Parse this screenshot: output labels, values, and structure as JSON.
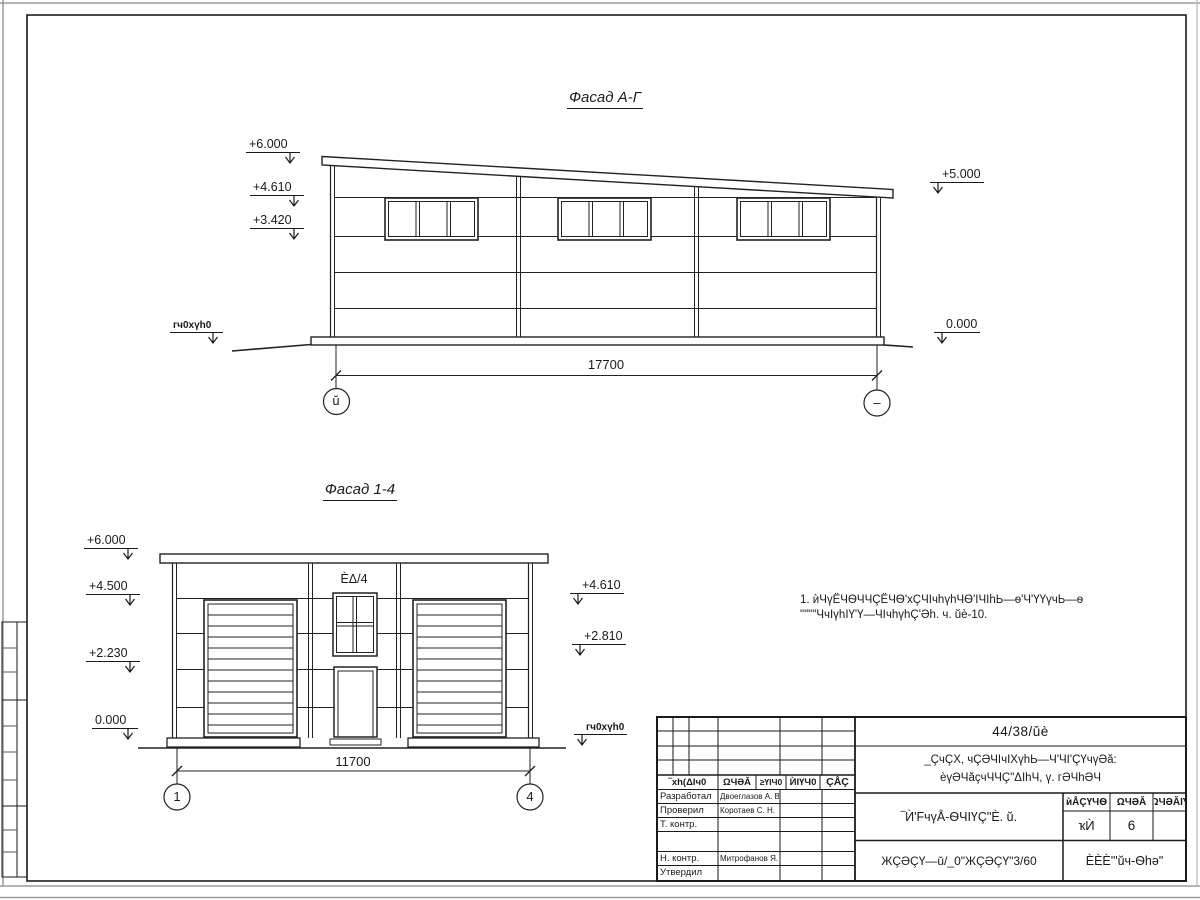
{
  "drawing": {
    "facade_top": {
      "title": "Фасад А-Г",
      "dimension": "17700",
      "axis_left": "ŭ",
      "axis_right": "–",
      "elevations": [
        "+6.000",
        "+4.610",
        "+3.420",
        "+5.000",
        "0.000"
      ],
      "ground_label": "ᴦч0хүh0"
    },
    "facade_bottom": {
      "title": "Фасад 1-4",
      "dimension": "11700",
      "axis_left": "1",
      "axis_right": "4",
      "window_label": "ÈΔ/4",
      "elevations": [
        "+6.000",
        "+4.500",
        "+2.230",
        "0.000",
        "+4.610",
        "+2.810"
      ],
      "ground_label": "ᴦч0хүh0"
    },
    "note": {
      "line1": "1. ѝЧүЁЧѲЧЧÇЁЧѲ'хÇЧІчhүhЧѲ'ІЧІhЬ—ѳ'Ч'ҮҮүчЬ—ѳ",
      "line2": "\"\"\"\"ЧчІүhІҮ'Ү—ЧІчhүhÇ'Әh. ч. ŭè-10."
    },
    "title_block": {
      "doc_code": "44/38/ŭè",
      "project_line1": "_ÇчÇХ, чÇӘЧІчІХүhЬ—Ч'ЧІ'ÇҮчүӘă:",
      "project_line2": "ѐүӘЧăçчЧЧÇ\"ΔІһЧ, ү. ᴦӘЧһӘЧ",
      "drawing_title": "‾Ѝ'FчүÅ-ѲЧІҮÇ\"È. ŭ.",
      "org_line": "ЖÇӘÇҮ—ŭ/_0\"ЖÇӘÇҮ\"3/60",
      "company": "ÈÈÈ'\"ŭч-Ѳһә\"",
      "columns": [
        "‾хh(ΔІч0",
        "ΩЧӘĂ",
        "≥ҮІЧ0",
        "ЍІҮЧ0",
        "ÇÅÇ"
      ],
      "stadia_headers": [
        "ѝÅÇҮЧѲ",
        "ΩЧӘĂ",
        "ΩЧӘĂІҮ"
      ],
      "stadia_values": [
        "ҡЍ",
        "6",
        ""
      ],
      "rows": [
        {
          "role": "Разработал",
          "name": "Двоеглазов А. В."
        },
        {
          "role": "Проверил",
          "name": "Коротаев С. Н."
        },
        {
          "role": "Т. контр.",
          "name": ""
        },
        {
          "role": "",
          "name": ""
        },
        {
          "role": "Н. контр.",
          "name": "Митрофанов Я. А."
        },
        {
          "role": "Утвердил",
          "name": ""
        }
      ]
    }
  }
}
